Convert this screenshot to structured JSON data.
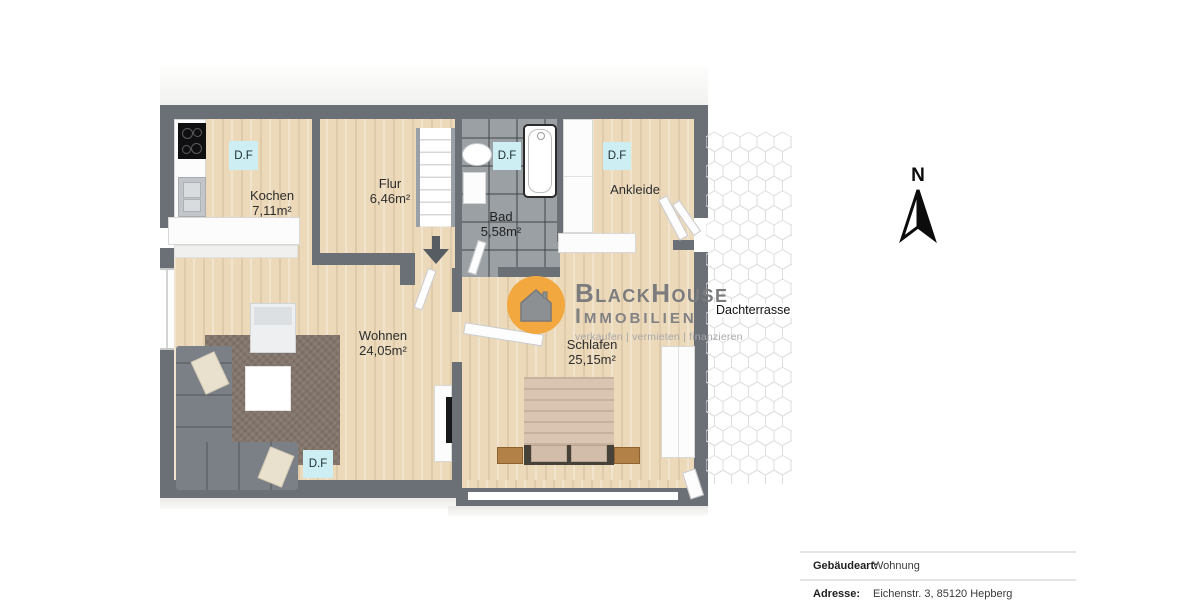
{
  "floorplan": {
    "skylight": "D.F",
    "north": "N",
    "rooms": {
      "kochen": {
        "name": "Kochen",
        "area": "7,11m²"
      },
      "flur": {
        "name": "Flur",
        "area": "6,46m²"
      },
      "bad": {
        "name": "Bad",
        "area": "5,58m²"
      },
      "ankleide": {
        "name": "Ankleide"
      },
      "wohnen": {
        "name": "Wohnen",
        "area": "24,05m²"
      },
      "schlafen": {
        "name": "Schlafen",
        "area": "25,15m²"
      },
      "terrasse": {
        "name": "Dachterrasse"
      }
    }
  },
  "logo": {
    "line1": "BlackHouse",
    "line2": "Immobilien",
    "tagline": "verkaufen | vermieten | finanzieren"
  },
  "details": {
    "rows": [
      {
        "label": "Gebäudeart:",
        "value": "Wohnung"
      },
      {
        "label": "Adresse:",
        "value": "Eichenstr. 3, 85120 Hepberg"
      }
    ]
  },
  "colors": {
    "wall": "#6b7077",
    "wood_floor": "#ebd9ba",
    "bath_tile": "#9ba0a5",
    "skylight_cyan": "#cdeef2",
    "logo_orange": "#f2a83e",
    "logo_gray": "#7c7c7e"
  }
}
